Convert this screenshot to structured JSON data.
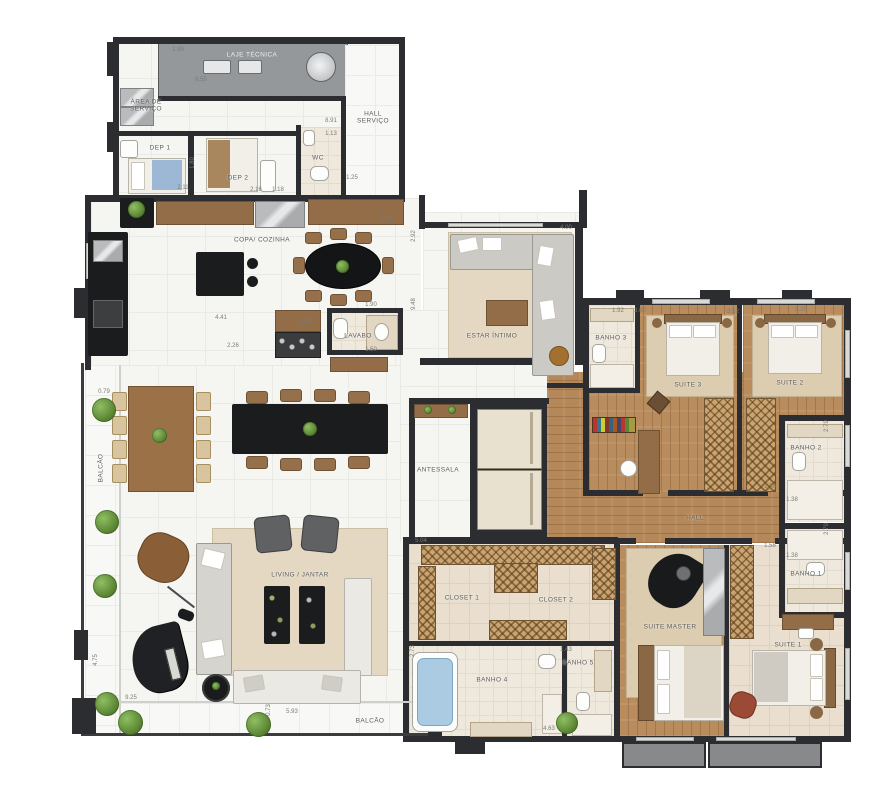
{
  "plan": {
    "type": "residential-floor-plan",
    "language": "pt-BR",
    "colors": {
      "wall": "#2b2d30",
      "wood_floor": "#b98c5e",
      "tile_floor": "#f5f5f2",
      "bath_floor": "#efe8dc",
      "rug": "#e4d8c2",
      "closet_hatch": "#c9a470",
      "tub_blue": "#aacbe2",
      "plant_green": "#6b9a44",
      "technical_gray": "#95989a"
    },
    "rooms": [
      {
        "label": "LAJE TÉCNICA"
      },
      {
        "label": "HALL SERVIÇO"
      },
      {
        "label": "ÁREA DE SERVIÇO"
      },
      {
        "label": "DEP 1"
      },
      {
        "label": "DEP 2"
      },
      {
        "label": "WC"
      },
      {
        "label": "COPA/ COZINHA"
      },
      {
        "label": "LAVABO"
      },
      {
        "label": "ESTAR ÍNTIMO"
      },
      {
        "label": "ANTESSALA"
      },
      {
        "label": "BANHO 3"
      },
      {
        "label": "SUITE 3"
      },
      {
        "label": "SUITE 2"
      },
      {
        "label": "BANHO 2"
      },
      {
        "label": "HALL"
      },
      {
        "label": "BANHO 1"
      },
      {
        "label": "SUITE 1"
      },
      {
        "label": "SUITE MASTER"
      },
      {
        "label": "CLOSET 1"
      },
      {
        "label": "CLOSET 2"
      },
      {
        "label": "BANHO 4"
      },
      {
        "label": "BANHO 5"
      },
      {
        "label": "LIVING / JANTAR"
      },
      {
        "label": "BALCÃO"
      },
      {
        "label": "BALCÃO"
      }
    ],
    "dims": [
      {
        "label": "1.99"
      },
      {
        "label": "6.55"
      },
      {
        "label": "8.91"
      },
      {
        "label": "1.13"
      },
      {
        "label": "1.25"
      },
      {
        "label": "2.16"
      },
      {
        "label": "1.18"
      },
      {
        "label": "2.11"
      },
      {
        "label": "1.80"
      },
      {
        "label": "8.63"
      },
      {
        "label": "2.92"
      },
      {
        "label": "9.48"
      },
      {
        "label": "4.41"
      },
      {
        "label": "2.26"
      },
      {
        "label": "2.89"
      },
      {
        "label": "1.50"
      },
      {
        "label": "1.90"
      },
      {
        "label": "4.00"
      },
      {
        "label": "1.92"
      },
      {
        "label": "3.60"
      },
      {
        "label": "3.52"
      },
      {
        "label": "3.20"
      },
      {
        "label": "1.58"
      },
      {
        "label": "1.38"
      },
      {
        "label": "2.79"
      },
      {
        "label": "2.79"
      },
      {
        "label": "1.58"
      },
      {
        "label": "1.38"
      },
      {
        "label": "5.04"
      },
      {
        "label": "2.73"
      },
      {
        "label": "1.43"
      },
      {
        "label": "4.63"
      },
      {
        "label": "9.25"
      },
      {
        "label": "5.93"
      },
      {
        "label": "0.73"
      },
      {
        "label": "0.79"
      },
      {
        "label": "4.75"
      }
    ]
  }
}
